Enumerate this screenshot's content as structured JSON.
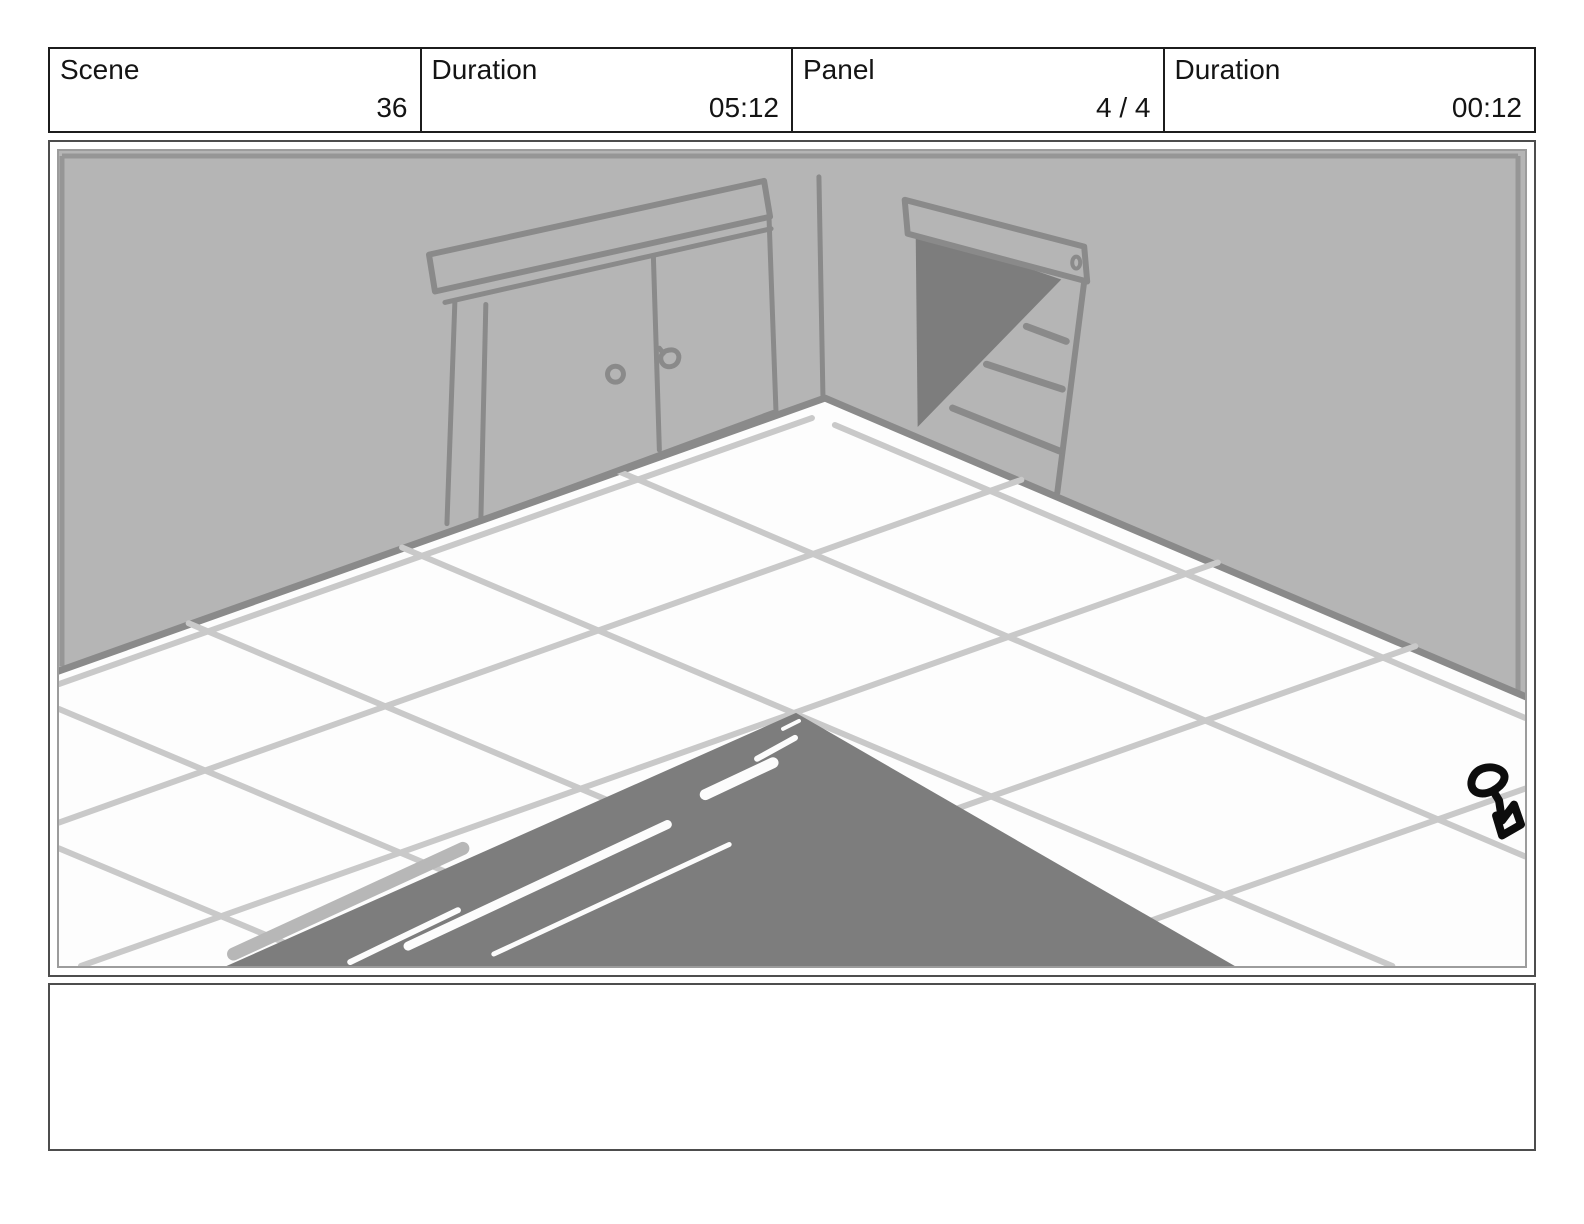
{
  "header": {
    "cells": [
      {
        "label": "Scene",
        "value": "36"
      },
      {
        "label": "Duration",
        "value": "05:12"
      },
      {
        "label": "Panel",
        "value": "4 / 4"
      },
      {
        "label": "Duration",
        "value": "00:12"
      }
    ]
  },
  "panel": {
    "description": "Hand-drawn storyboard sketch: corner of a room with white tiled floor, a closed double-door cabinet on the left wall, an open doorway with stairs on the right wall, a dark triangular ramp shape in the foreground and a small black ink scribble near the right edge",
    "colors": {
      "wall": "#b5b5b5",
      "outline": "#8a8a8a",
      "shadow": "#7d7d7d",
      "tile_line": "#c9c9c9",
      "light_stripe": "#b7b7b7",
      "ink": "#0d0d0d"
    }
  },
  "notes": {
    "value": ""
  }
}
